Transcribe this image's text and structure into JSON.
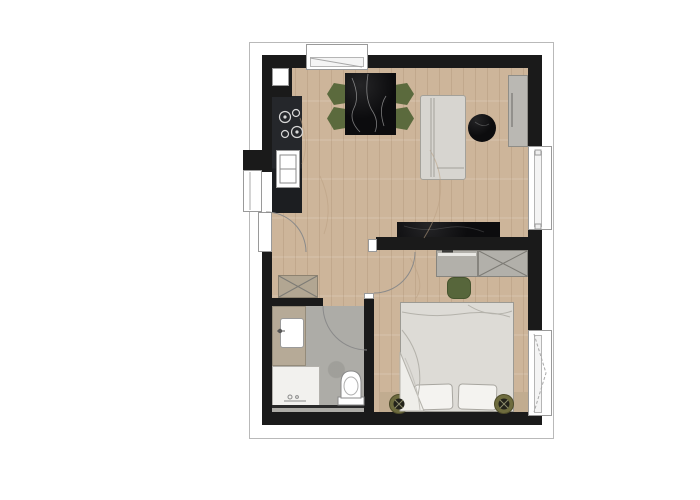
{
  "app": {
    "type": "architectural-floor-plan",
    "title": "apartment-floor-plan",
    "visible_text": []
  },
  "canvas": {
    "width": 700,
    "height": 500,
    "background": "#ffffff"
  },
  "palette": {
    "wall": "#1a1a1a",
    "outline": "#b9b9b9",
    "wood": "#cdb59a",
    "bath-floor": "#adaca7",
    "counter": "#25272b",
    "counter-dark": "#1c1e21",
    "marble": "#0c0c0e",
    "chair-green": "#5b6a3d",
    "pouf-green": "#57663b",
    "sofa": "#d7d5d0",
    "sofa-line": "#a3a19a",
    "cabinet-gray": "#b2b0aa",
    "cabinet-line": "#86847e",
    "sideboard": "#bab8b3",
    "bed-duvet": "#dddbd6",
    "bed-line": "#9c9a93",
    "pillow": "#f4f3f0",
    "headboard": "#c1ac90",
    "vanity": "#b6aa97",
    "shower": "#f2f1ee",
    "lamp-ring": "#6e6c3e",
    "lamp-core": "#22221a",
    "door-arc": "#8a8a8a",
    "window-frame": "#9a9a9a"
  },
  "rooms": [
    {
      "name": "living-dining-kitchen",
      "floor": "wood"
    },
    {
      "name": "hallway",
      "floor": "wood"
    },
    {
      "name": "bathroom",
      "floor": "gray-stone"
    },
    {
      "name": "bedroom",
      "floor": "wood"
    }
  ],
  "fixtures": {
    "kitchen": [
      "kitchen-counter",
      "cooktop-four-burners",
      "kitchen-sink",
      "utility-shaft"
    ],
    "living": [
      "dining-table-black-marble",
      "dining-chairs-green-x4",
      "sofa",
      "round-coffee-table-black-marble",
      "wall-sideboard",
      "media-bench-black-marble"
    ],
    "hallway": [
      "entry-door-opening",
      "hall-wardrobe-crossed"
    ],
    "bathroom": [
      "vanity-counter",
      "washbasin",
      "shower",
      "toilet",
      "bathroom-door-with-swing"
    ],
    "bedroom": [
      "desk-with-laptop",
      "wardrobe-crossed",
      "green-pouf",
      "double-bed",
      "pillows-x2",
      "headboard",
      "bedside-lamps-x2",
      "bedroom-door-swing"
    ]
  },
  "windows": [
    "top-wall-window",
    "left-wall-window",
    "right-wall-living-window",
    "right-wall-bedroom-window"
  ],
  "doors": [
    "entry-door",
    "bedroom-door",
    "bathroom-door"
  ]
}
